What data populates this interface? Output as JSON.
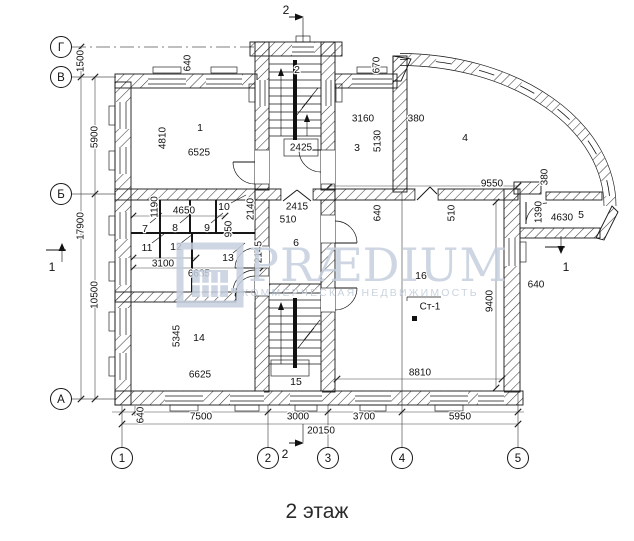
{
  "title": "2 этаж",
  "watermark": {
    "brand": "PRÆDIUM",
    "tagline": "КОММЕРЧЕСКАЯ НЕДВИЖИМОСТЬ"
  },
  "colors": {
    "line": "#161616",
    "watermark": "#c5d0dd",
    "background": "#ffffff"
  },
  "axes": {
    "row_g": "Г",
    "row_v": "В",
    "row_b": "Б",
    "row_a": "А",
    "col_1": "1",
    "col_2": "2",
    "col_3": "3",
    "col_4": "4",
    "col_5": "5"
  },
  "sections": {
    "s1": "1",
    "s2": "2"
  },
  "column_mark": "Ст-1",
  "rooms": {
    "r1": "1",
    "r2": "2",
    "r3": "3",
    "r4": "4",
    "r5": "5",
    "r6": "6",
    "r7": "7",
    "r8": "8",
    "r9": "9",
    "r10": "10",
    "r11": "11",
    "r12": "12",
    "r13": "13",
    "r14": "14",
    "r15": "15",
    "r16": "16"
  },
  "dims": {
    "left_1500": "1500",
    "left_5900": "5900",
    "left_10500": "10500",
    "left_total": "17900",
    "bottom_640": "640",
    "bottom_7500": "7500",
    "bottom_3000": "3000",
    "bottom_3700": "3700",
    "bottom_5950": "5950",
    "bottom_total": "20150",
    "top_640": "640",
    "top_670": "670",
    "r1_w": "6525",
    "r1_h": "4810",
    "lobby_w": "2425",
    "r3_w": "3160",
    "r3_h": "5130",
    "r3_wall": "380",
    "r4_w": "9550",
    "r4_wall": "380",
    "r5_w": "4630",
    "r5_h": "1390",
    "r6_a": "2415",
    "r6_b": "510",
    "c_1190": "1190",
    "c_4650": "4650",
    "c_2140": "2140",
    "c_950": "950",
    "c_2145": "2145",
    "c_3100": "3100",
    "c_6635": "6635",
    "r14_w": "6625",
    "r14_h": "5345",
    "r16_w": "8810",
    "r16_h": "9400",
    "r16_640": "640",
    "r16_510": "510",
    "r16_640b": "640"
  }
}
